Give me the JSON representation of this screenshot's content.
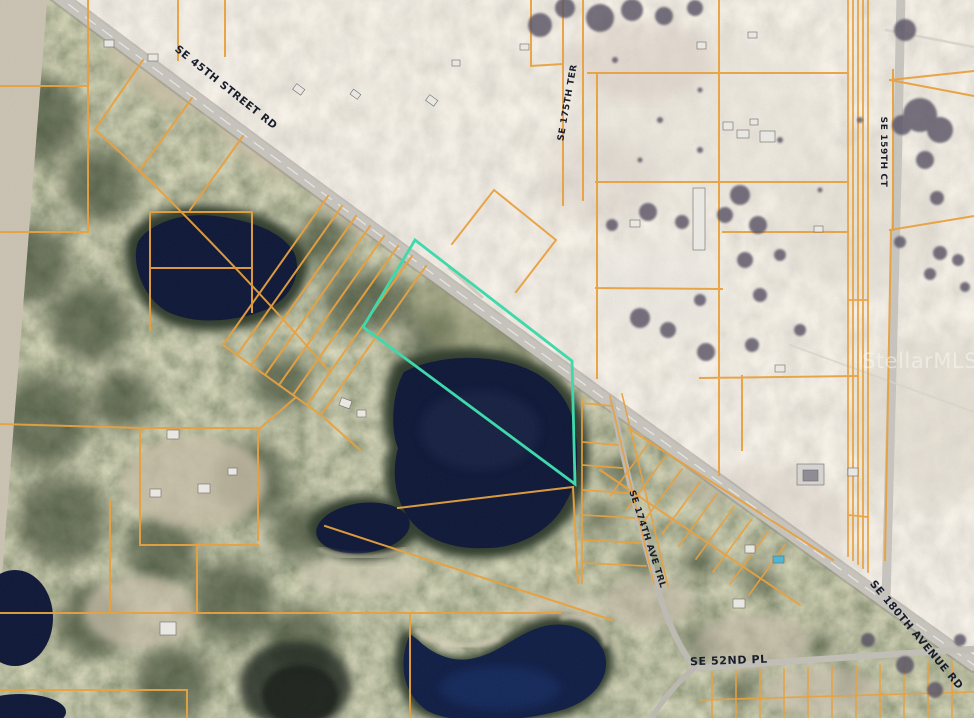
{
  "map": {
    "watermark": "StellarMLS",
    "road_labels": {
      "se_45th": "SE 45TH STREET RD",
      "se_180th": "SE 180TH AVENUE RD",
      "se_52nd": "SE 52ND PL",
      "se_174th": "SE 174TH AVE TRL",
      "se_175th_ter": "SE 175TH TER",
      "se_159th_ct": "SE 159TH CT"
    },
    "colors": {
      "parcel_line": "#EBA23C",
      "subject_highlight": "#3BDCAD",
      "water": "#0C1636",
      "road_label": "#131829",
      "watermark": "#FFFFFF"
    }
  }
}
